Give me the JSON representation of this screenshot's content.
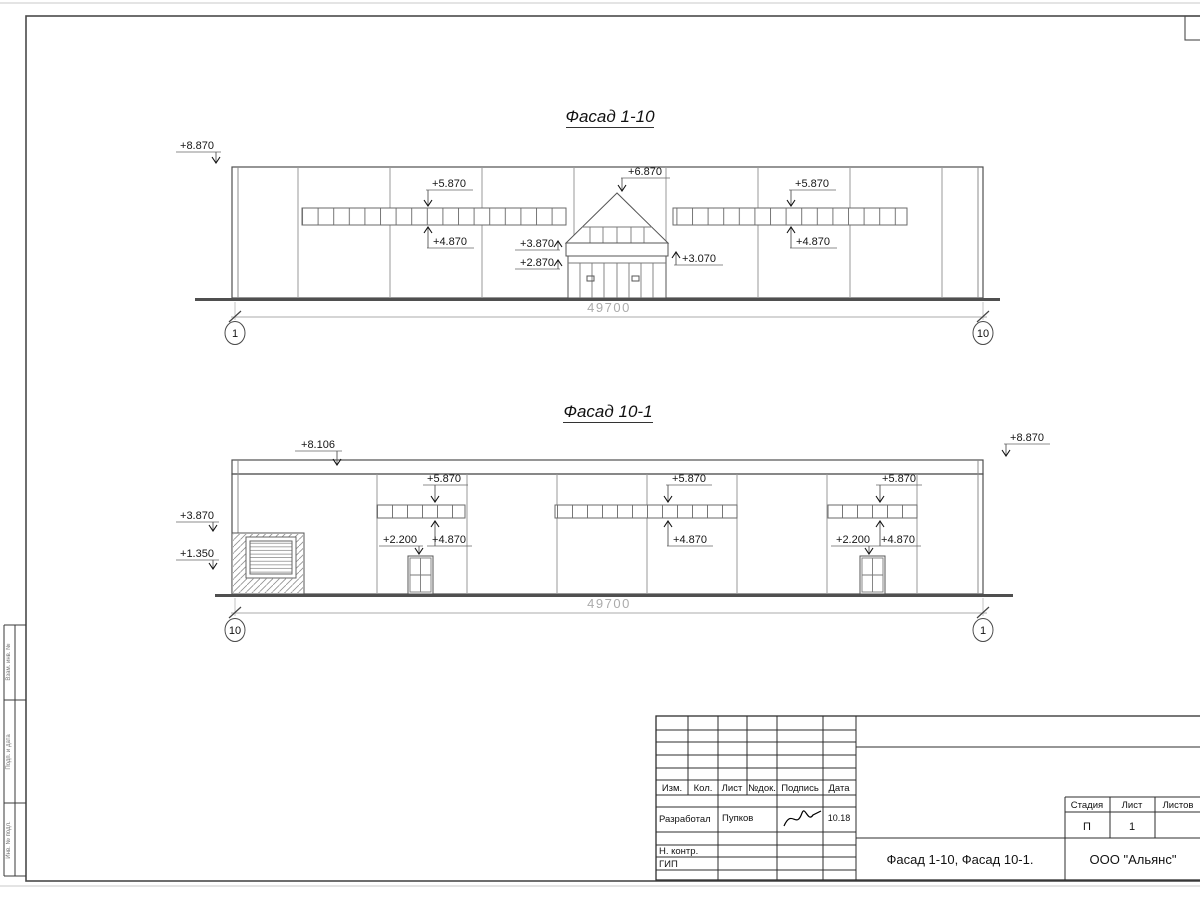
{
  "sheet": {
    "facade1": {
      "title": "Фасад 1-10",
      "dimension": "49700",
      "axis_left": "1",
      "axis_right": "10",
      "marks": [
        {
          "label": "+8.870",
          "tx": 197,
          "ty": 149,
          "s1": 176,
          "s2": 221,
          "lx": 216,
          "ay": 163,
          "dir": "down"
        },
        {
          "label": "+6.870",
          "tx": 645,
          "ty": 175,
          "s1": 621,
          "s2": 670,
          "lx": 622,
          "ay": 191,
          "dir": "down"
        },
        {
          "label": "+5.870",
          "tx": 449,
          "ty": 187,
          "s1": 426,
          "s2": 473,
          "lx": 428,
          "ay": 206,
          "dir": "down"
        },
        {
          "label": "+5.870",
          "tx": 812,
          "ty": 187,
          "s1": 789,
          "s2": 836,
          "lx": 791,
          "ay": 206,
          "dir": "down"
        },
        {
          "label": "+4.870",
          "tx": 450,
          "ty": 245,
          "s1": 427,
          "s2": 474,
          "lx": 428,
          "ay": 227,
          "dir": "up"
        },
        {
          "label": "+4.870",
          "tx": 813,
          "ty": 245,
          "s1": 790,
          "s2": 837,
          "lx": 791,
          "ay": 227,
          "dir": "up"
        },
        {
          "label": "+3.870",
          "tx": 537,
          "ty": 247,
          "s1": 515,
          "s2": 560,
          "lx": 558,
          "ay": 241,
          "dir": "up"
        },
        {
          "label": "+2.870",
          "tx": 537,
          "ty": 266,
          "s1": 515,
          "s2": 560,
          "lx": 558,
          "ay": 260,
          "dir": "up"
        },
        {
          "label": "+3.070",
          "tx": 699,
          "ty": 262,
          "s1": 674,
          "s2": 723,
          "lx": 676,
          "ay": 252,
          "dir": "up"
        }
      ]
    },
    "facade2": {
      "title": "Фасад 10-1",
      "dimension": "49700",
      "axis_left": "10",
      "axis_right": "1",
      "marks": [
        {
          "label": "+8.106",
          "tx": 318,
          "ty": 448,
          "s1": 295,
          "s2": 342,
          "lx": 337,
          "ay": 465,
          "dir": "down"
        },
        {
          "label": "+8.870",
          "tx": 1027,
          "ty": 441,
          "s1": 1004,
          "s2": 1050,
          "lx": 1006,
          "ay": 456,
          "dir": "down"
        },
        {
          "label": "+3.870",
          "tx": 197,
          "ty": 519,
          "s1": 176,
          "s2": 219,
          "lx": 213,
          "ay": 531,
          "dir": "down"
        },
        {
          "label": "+1.350",
          "tx": 197,
          "ty": 557,
          "s1": 176,
          "s2": 219,
          "lx": 213,
          "ay": 569,
          "dir": "down"
        },
        {
          "label": "+5.870",
          "tx": 444,
          "ty": 482,
          "s1": 423,
          "s2": 468,
          "lx": 435,
          "ay": 502,
          "dir": "down"
        },
        {
          "label": "+4.870",
          "tx": 449,
          "ty": 543,
          "s1": 427,
          "s2": 472,
          "lx": 435,
          "ay": 521,
          "dir": "up"
        },
        {
          "label": "+2.200",
          "tx": 400,
          "ty": 543,
          "s1": 379,
          "s2": 423,
          "lx": 419,
          "ay": 554,
          "dir": "down"
        },
        {
          "label": "+5.870",
          "tx": 689,
          "ty": 482,
          "s1": 666,
          "s2": 712,
          "lx": 668,
          "ay": 502,
          "dir": "down"
        },
        {
          "label": "+4.870",
          "tx": 690,
          "ty": 543,
          "s1": 667,
          "s2": 713,
          "lx": 668,
          "ay": 521,
          "dir": "up"
        },
        {
          "label": "+5.870",
          "tx": 899,
          "ty": 482,
          "s1": 876,
          "s2": 922,
          "lx": 880,
          "ay": 502,
          "dir": "down"
        },
        {
          "label": "+4.870",
          "tx": 898,
          "ty": 543,
          "s1": 875,
          "s2": 921,
          "lx": 880,
          "ay": 521,
          "dir": "up"
        },
        {
          "label": "+2.200",
          "tx": 853,
          "ty": 543,
          "s1": 831,
          "s2": 875,
          "lx": 869,
          "ay": 554,
          "dir": "down"
        }
      ]
    },
    "stamp": {
      "cols": [
        "Изм.",
        "Кол.",
        "Лист",
        "№док.",
        "Подпись",
        "Дата"
      ],
      "developed_label": "Разработал",
      "developed_name": "Пупков",
      "developed_date": "10.18",
      "ncontr_label": "Н. контр.",
      "gip_label": "ГИП",
      "stage_label": "Стадия",
      "sheet_label": "Лист",
      "sheets_label": "Листов",
      "stage_value": "П",
      "sheet_value": "1",
      "doc_title": "Фасад 1-10, Фасад 10-1.",
      "company": "ООО \"Альянс\""
    },
    "margin_labels": [
      "Взам. инв. №",
      "Подп. и дата",
      "Инв. № подл."
    ]
  }
}
